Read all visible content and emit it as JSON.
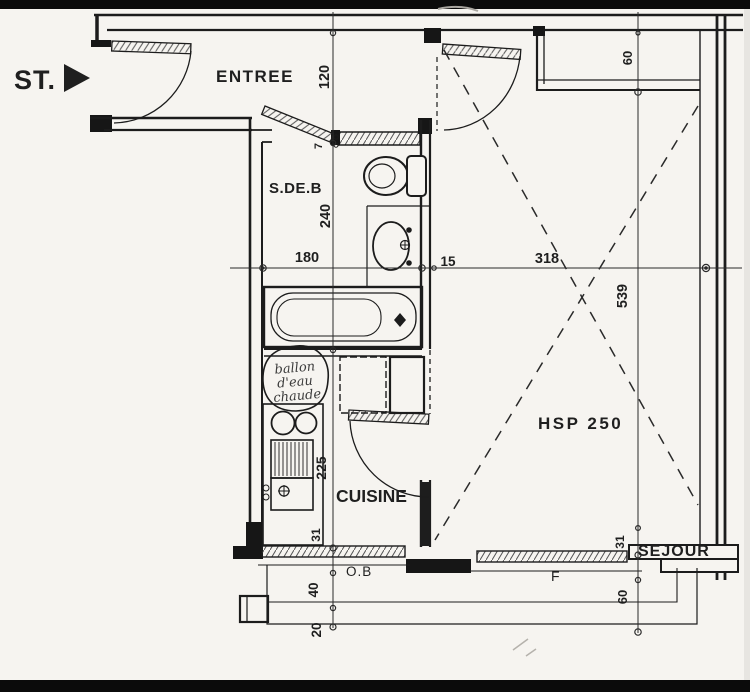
{
  "colors": {
    "paper": "#f6f4f0",
    "ink": "#1f1f1f",
    "scan_bar": "#0b0b0b"
  },
  "labels": {
    "st": "ST.",
    "entree": "ENTREE",
    "sdeb": "S.DE.B",
    "cuisine": "CUISINE",
    "sejour": "SEJOUR",
    "hsp": "HSP 250",
    "window_ob": "O.B",
    "window_f": "F"
  },
  "annotations": {
    "water_heater": [
      "ballon",
      "d'eau",
      "chaude"
    ]
  },
  "dimensions": {
    "horizontal": {
      "bathroom_width": "180",
      "partition_gap": "15",
      "living_width": "318"
    },
    "left": {
      "entry_depth": "120",
      "bath_depth": "240",
      "door_jamb": "7",
      "kitchen_depth": "225",
      "window_sill": "31",
      "balcony_depth": "40",
      "balcony_edge": "20"
    },
    "right": {
      "closet_depth": "60",
      "living_length": "539",
      "window_sill": "31",
      "balcony_depth": "60"
    }
  }
}
